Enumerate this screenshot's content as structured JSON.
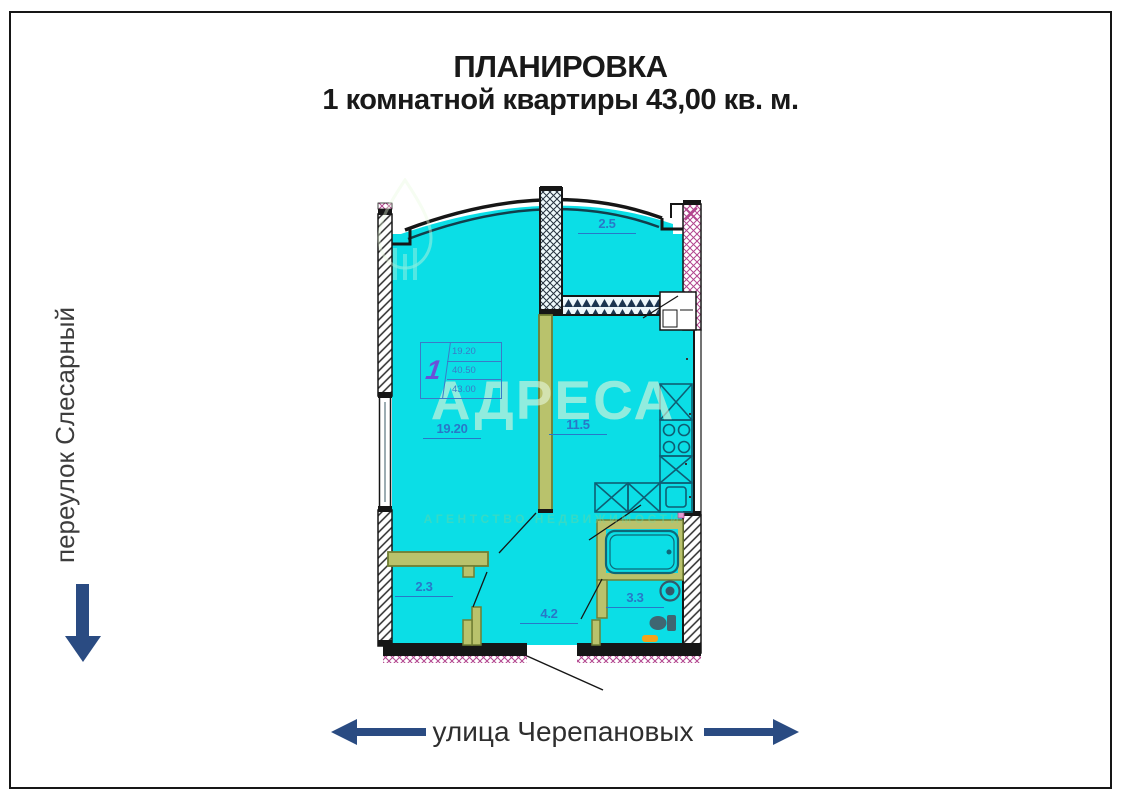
{
  "title": {
    "line1": "ПЛАНИРОВКА",
    "line2": "1 комнатной квартиры 43,00 кв. м."
  },
  "streets": {
    "left_street": "переулок Слесарный",
    "bottom_street": "улица Черепановых"
  },
  "watermark": {
    "brand": "АДРЕСА",
    "subtitle": "АГЕНТСТВО НЕДВИЖИМОСТИ"
  },
  "floorplan": {
    "rooms": [
      {
        "name": "balcony",
        "area": "2.5"
      },
      {
        "name": "living-room",
        "area": "19.20"
      },
      {
        "name": "kitchen",
        "area": "11.5"
      },
      {
        "name": "storage",
        "area": "2.3"
      },
      {
        "name": "hallway",
        "area": "4.2"
      },
      {
        "name": "bathroom",
        "area": "3.3"
      }
    ],
    "stamp": {
      "rooms_count": "1",
      "living_area": "19.20",
      "area_without_balcony": "40.50",
      "total_area": "43.00"
    },
    "colors": {
      "room_fill": "#0BDEE6",
      "label_blue": "#2878C8",
      "arrow_blue": "#2A4B82",
      "partition_olive": "#B9C26C",
      "wall_black": "#161616",
      "hatch_pink": "#B2458E",
      "accent_orange": "#F2A31B"
    }
  }
}
